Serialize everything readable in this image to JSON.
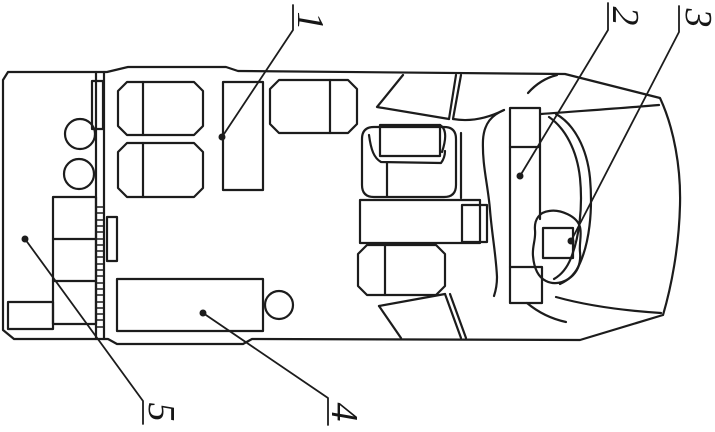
{
  "figure": {
    "background": "#ffffff",
    "line_color": "#1c1c1c",
    "labels": [
      {
        "text": "1"
      },
      {
        "text": "2"
      },
      {
        "text": "3"
      },
      {
        "text": "4"
      },
      {
        "text": "5"
      }
    ]
  }
}
